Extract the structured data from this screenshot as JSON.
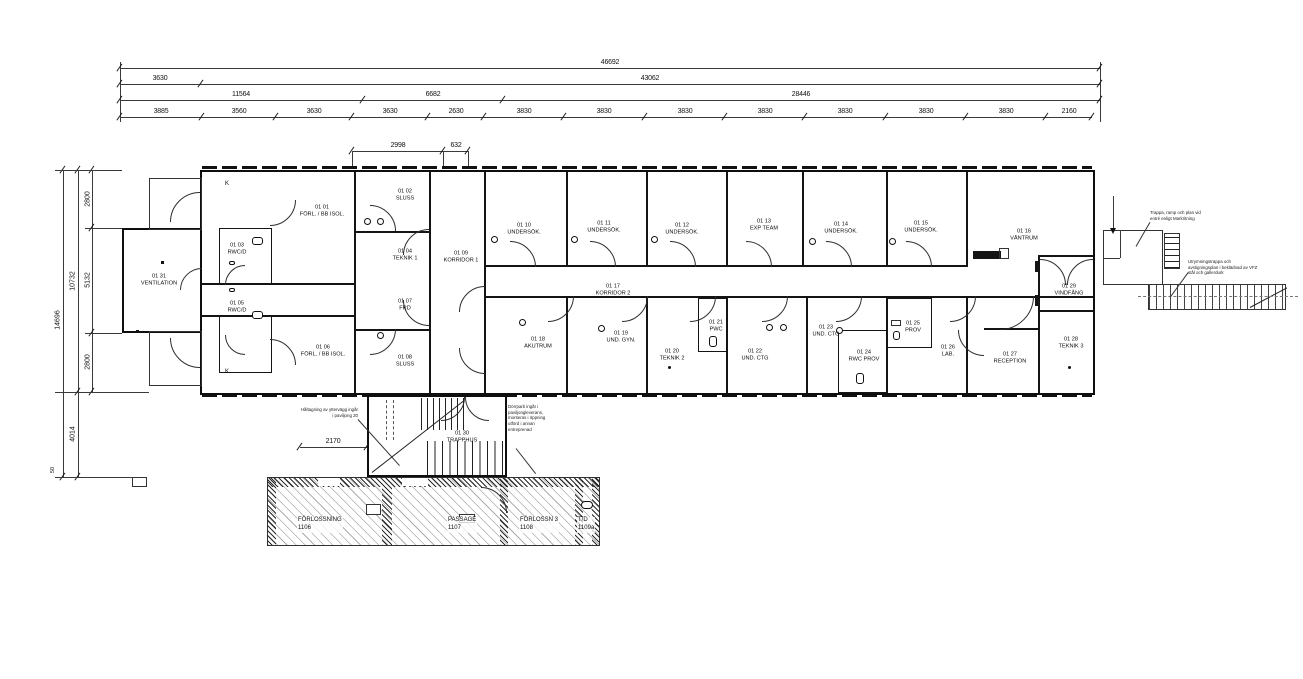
{
  "dims": {
    "row1": [
      "46692"
    ],
    "row2": [
      "3630",
      "43062"
    ],
    "row3": [
      "11564",
      "6682",
      "28446"
    ],
    "row4": [
      "3885",
      "3560",
      "3630",
      "3630",
      "2630",
      "3830",
      "3830",
      "3830",
      "3830",
      "3830",
      "3830",
      "3830",
      "2160"
    ],
    "left": {
      "total": "14696",
      "upper": "10732",
      "lower": "4014",
      "a": "2800",
      "b": "5132",
      "c": "2800",
      "small": "50"
    },
    "mid": {
      "a": "2998",
      "b": "632",
      "stair": "2170"
    }
  },
  "rooms": [
    {
      "num": "01 01",
      "name": "FÖRL. / BB ISOL."
    },
    {
      "num": "01 02",
      "name": "SLUSS"
    },
    {
      "num": "01 03",
      "name": "RWC/D"
    },
    {
      "num": "01 04",
      "name": "TEKNIK 1"
    },
    {
      "num": "01 05",
      "name": "RWC/D"
    },
    {
      "num": "01 06",
      "name": "FÖRL. / BB ISOL."
    },
    {
      "num": "01 07",
      "name": "FRD"
    },
    {
      "num": "01 08",
      "name": "SLUSS"
    },
    {
      "num": "01 09",
      "name": "KORRIDOR 1"
    },
    {
      "num": "01 10",
      "name": "UNDERSÖK."
    },
    {
      "num": "01 11",
      "name": "UNDERSÖK."
    },
    {
      "num": "01 12",
      "name": "UNDERSÖK."
    },
    {
      "num": "01 13",
      "name": "EXP TEAM"
    },
    {
      "num": "01 14",
      "name": "UNDERSÖK."
    },
    {
      "num": "01 15",
      "name": "UNDERSÖK."
    },
    {
      "num": "01 16",
      "name": "VÄNTRUM"
    },
    {
      "num": "01 17",
      "name": "KORRIDOR 2"
    },
    {
      "num": "01 18",
      "name": "AKUTRUM"
    },
    {
      "num": "01 19",
      "name": "UND. GYN."
    },
    {
      "num": "01 20",
      "name": "TEKNIK 2"
    },
    {
      "num": "01 21",
      "name": "PWC"
    },
    {
      "num": "01 22",
      "name": "UND. CTG"
    },
    {
      "num": "01 23",
      "name": "UND. CTG"
    },
    {
      "num": "01 24",
      "name": "RWC PROV"
    },
    {
      "num": "01 25",
      "name": "PROV"
    },
    {
      "num": "01 26",
      "name": "LAB."
    },
    {
      "num": "01 27",
      "name": "RECEPTION"
    },
    {
      "num": "01 28",
      "name": "TEKNIK 3"
    },
    {
      "num": "01 29",
      "name": "VINDFÅNG"
    },
    {
      "num": "01 30",
      "name": "TRAPPHUS"
    },
    {
      "num": "01 31",
      "name": "VENTILATION"
    }
  ],
  "existing_rooms": [
    {
      "name": "FÖRLOSSNING",
      "num": "1106"
    },
    {
      "name": "PASSAGE",
      "num": "1107"
    },
    {
      "name": "FÖRLOSSN 3",
      "num": "1108"
    },
    {
      "name": "T/D",
      "num": "1109a"
    }
  ],
  "annotations": {
    "entry_ramp": "Trappa, ramp och plan vid entré enligt Markritning",
    "escape_stair": "Utrymningstrappa och avstigningsplan i beklädnad av VFZ stål och gallerdurk",
    "wall_opening": "Håltagning av yttervägg ingår i paviljong 20",
    "door_section": "Dörrparti ingår i paviljongleverans, monteras i öppning utförd i annan entreprenad"
  },
  "markers": {
    "k": "K"
  }
}
